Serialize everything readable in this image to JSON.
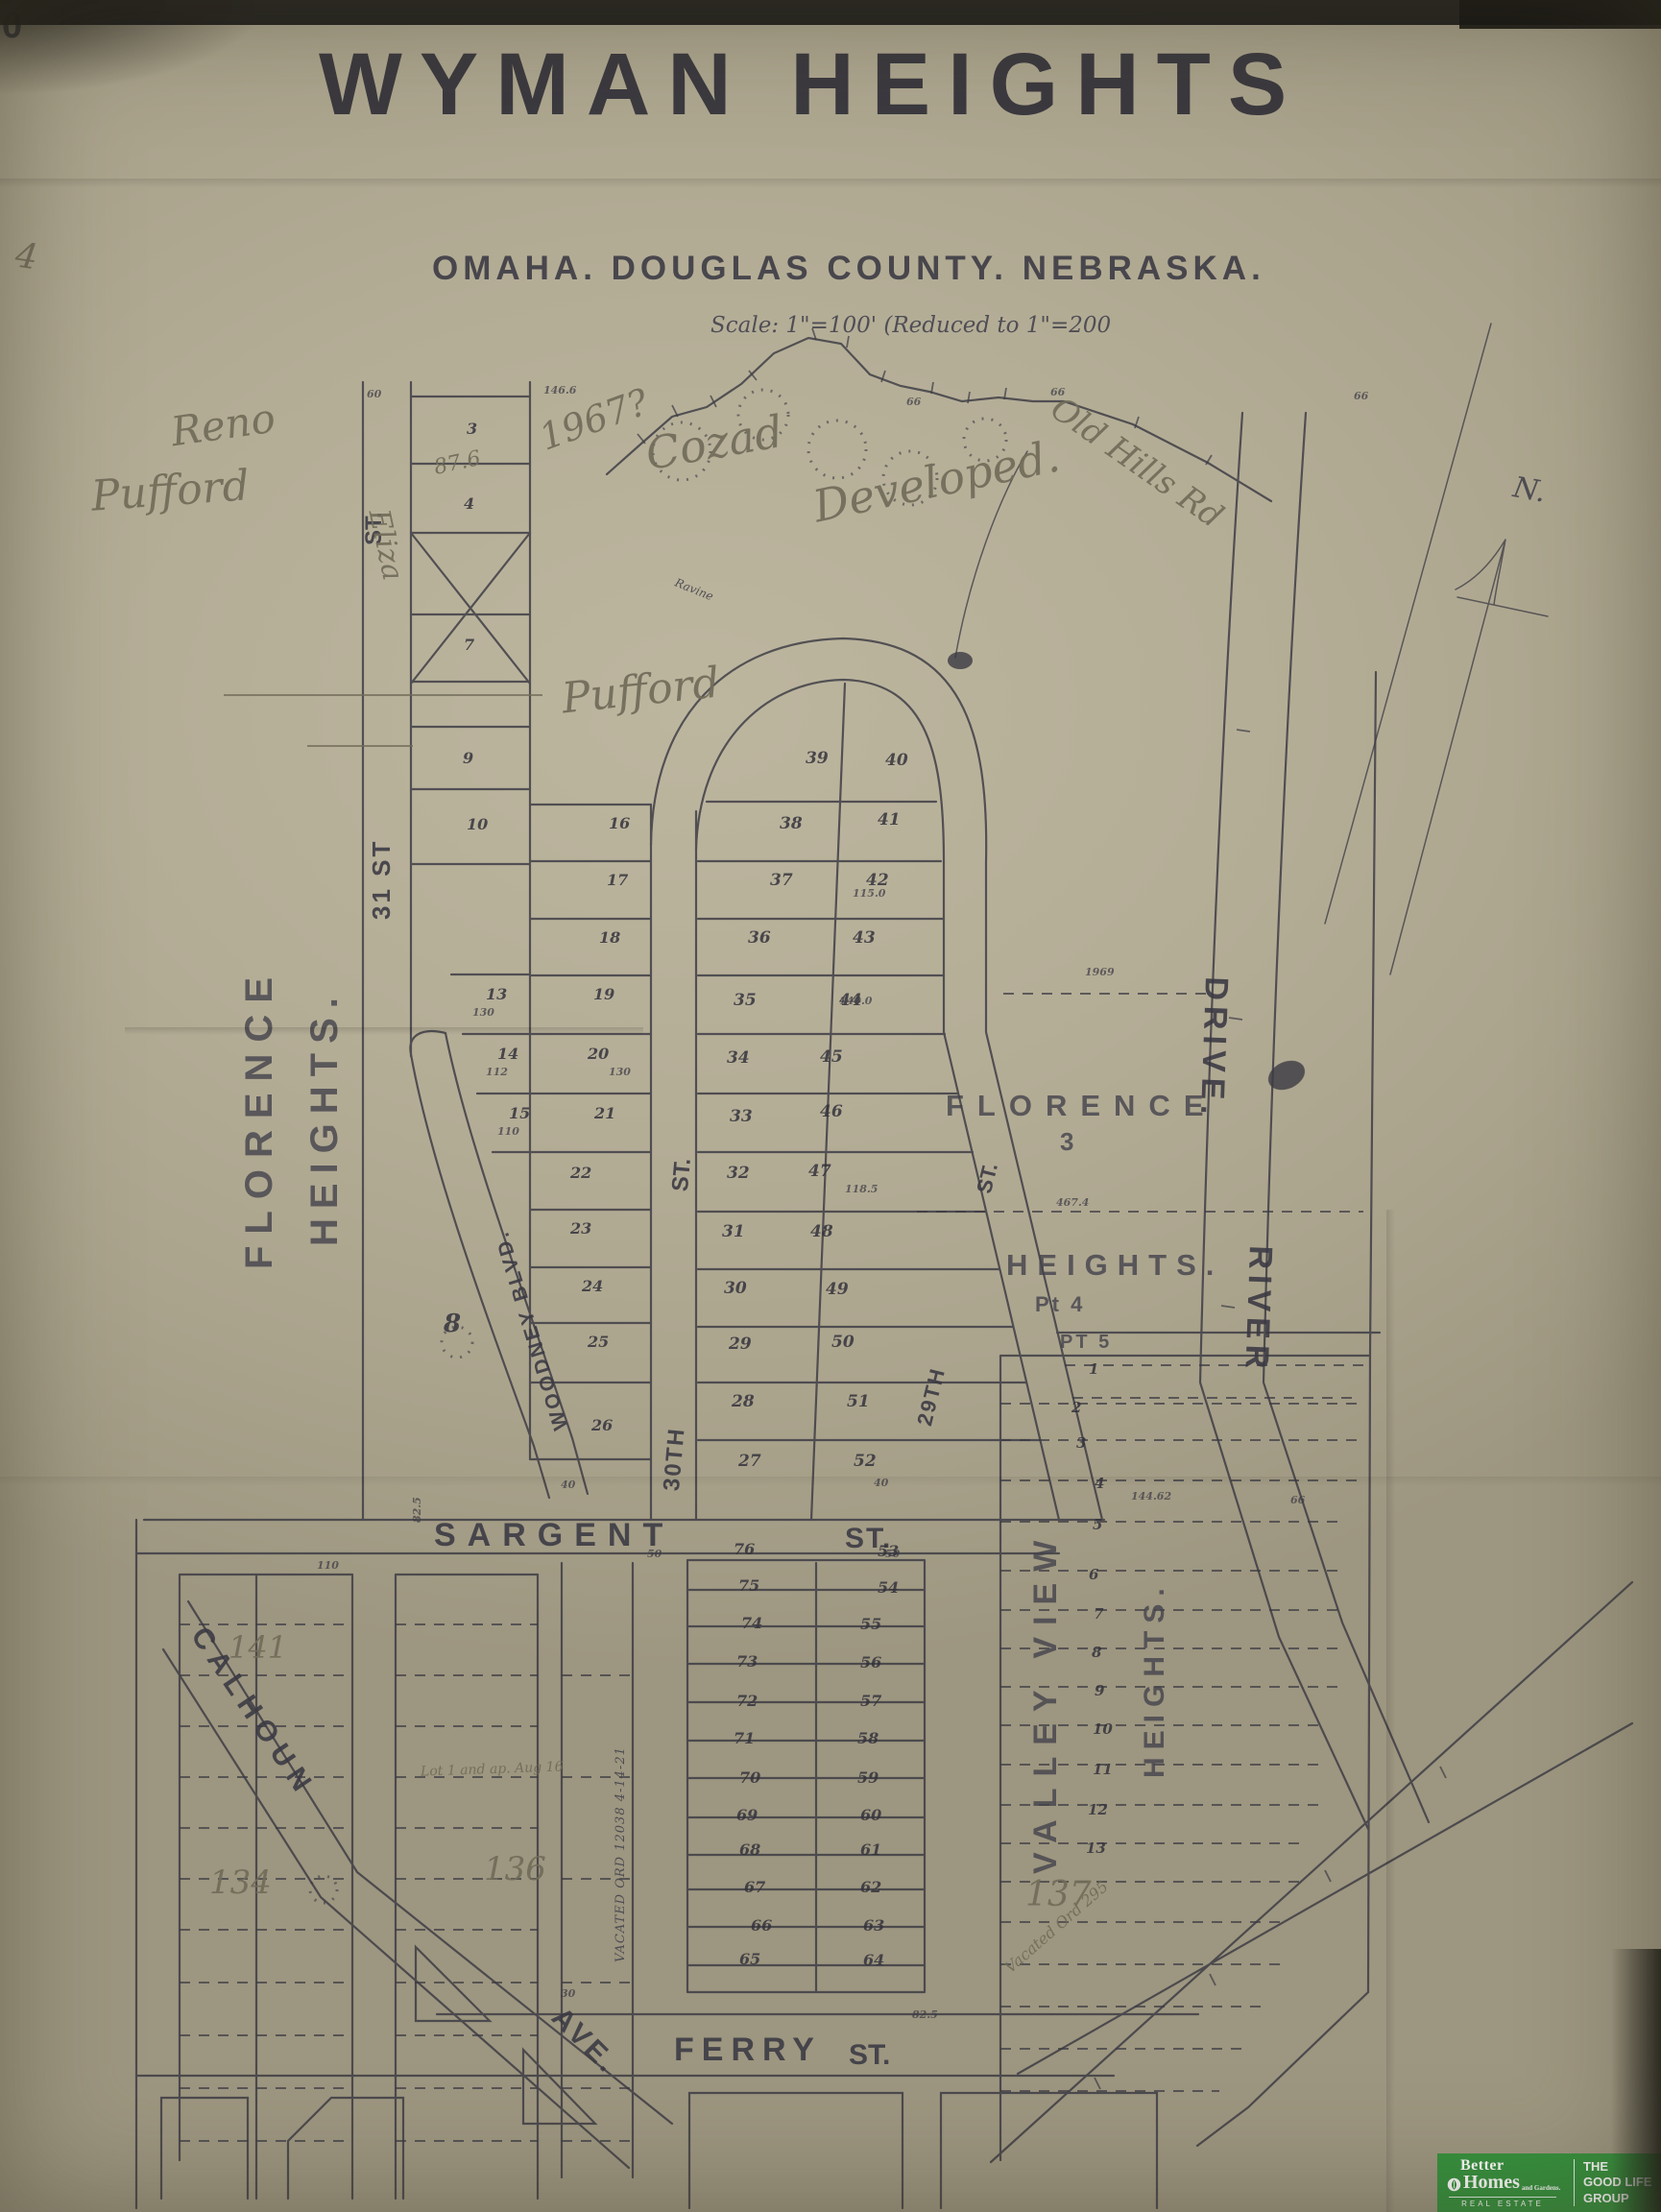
{
  "title": {
    "corner_mark": "0",
    "main": "WYMAN HEIGHTS",
    "subtitle": "OMAHA. DOUGLAS COUNTY. NEBRASKA.",
    "scale": "Scale: 1\"=100'   (Reduced to 1\"=200"
  },
  "compass": {
    "north": "N."
  },
  "streets": {
    "st_upper": "ST.",
    "thirty_first": "31 ST",
    "woodney": "WOODNEY BLVD.",
    "thirtieth": "30TH",
    "thirtieth_st": "ST.",
    "twenty_ninth": "29TH",
    "twenty_ninth_st": "ST.",
    "sargent": "SARGENT",
    "sargent_st": "ST.",
    "ferry": "FERRY",
    "ferry_st": "ST.",
    "calhoun": "CALHOUN",
    "ave": "AVE.",
    "river_drive_upper": "DRIVE.",
    "river_drive_lower": "RIVER"
  },
  "plats": {
    "florence_heights_w1": "FLORENCE",
    "florence_heights_w2": "HEIGHTS.",
    "florence_e1": "FLORENCE",
    "florence_e_num": "3",
    "florence_e2": "HEIGHTS.",
    "florence_pt4": "Pt 4",
    "florence_pt5": "PT 5",
    "valley_view": "VALLEY VIEW",
    "valley_heights": "HEIGHTS.",
    "lot8": "8"
  },
  "lots": {
    "col_a": [
      "3",
      "4",
      "7",
      "9",
      "10",
      "13",
      "14",
      "15"
    ],
    "col_b": [
      "16",
      "17",
      "18",
      "19",
      "20",
      "21",
      "22",
      "23",
      "24",
      "25",
      "26"
    ],
    "loop_w": [
      "39",
      "38",
      "37",
      "36",
      "35",
      "34",
      "33",
      "32",
      "31",
      "30",
      "29",
      "28",
      "27"
    ],
    "loop_e": [
      "40",
      "41",
      "42",
      "43",
      "44",
      "45",
      "46",
      "47",
      "48",
      "49",
      "50",
      "51",
      "52"
    ],
    "south_w": [
      "76",
      "75",
      "74",
      "73",
      "72",
      "71",
      "70",
      "69",
      "68",
      "67",
      "66",
      "65"
    ],
    "south_e": [
      "53",
      "54",
      "55",
      "56",
      "57",
      "58",
      "59",
      "60",
      "61",
      "62",
      "63",
      "64"
    ],
    "valley": [
      "1",
      "2",
      "3",
      "4",
      "5",
      "6",
      "7",
      "8",
      "9",
      "10",
      "11",
      "12",
      "13"
    ]
  },
  "dims": {
    "values": [
      "60",
      "146.6",
      "66",
      "66",
      "40",
      "40",
      "50",
      "50",
      "82.5",
      "30",
      "82.5",
      "66",
      "130",
      "112",
      "110",
      "115.0",
      "118.5",
      "130",
      "140.0",
      "1969",
      "467.4",
      "144.62",
      "110",
      "66"
    ]
  },
  "annotations": {
    "margin": "4",
    "year": "1967?",
    "cozad": "Cozad",
    "old_hills": "Old Hills Rd",
    "developed": "Developed.",
    "reno": "Reno",
    "pufford_a": "Pufford",
    "pufford_b": "Pufford",
    "eliza": "Eliza",
    "n876": "87.6",
    "ravine": "Ravine",
    "blk141": "141",
    "blk134": "134",
    "blk136": "136",
    "blk137": "137",
    "lot_note": "Lot 1 and ap. Aug 16",
    "vacated_strip": "VACATED ORD 12038 4-14-21",
    "vacated_road": "Vacated Ord 295"
  },
  "logo": {
    "brand_line1": "Better",
    "brand_line2": "Homes",
    "brand_suffix": "and Gardens.",
    "brand_footer": "REAL ESTATE",
    "group_line1": "THE",
    "group_line2": "GOOD LIFE",
    "group_line3": "GROUP"
  }
}
